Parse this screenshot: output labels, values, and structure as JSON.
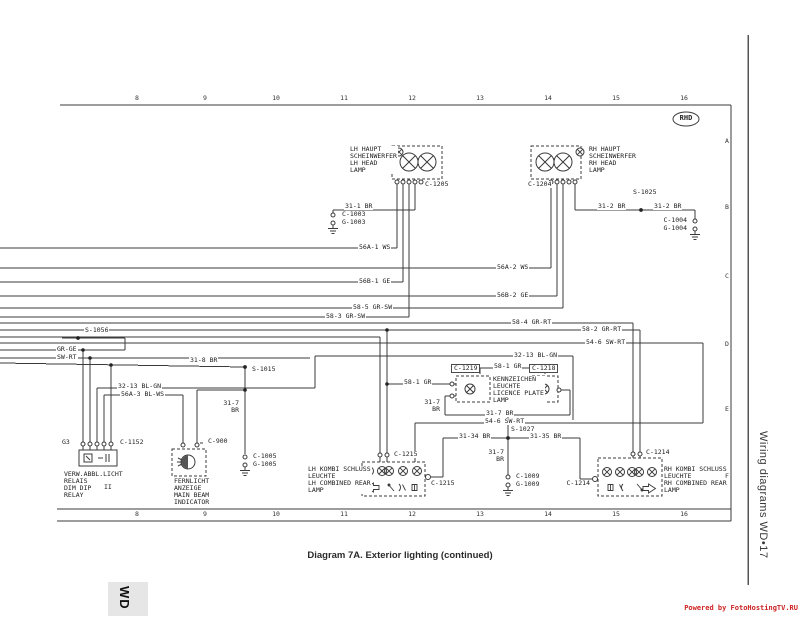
{
  "page": {
    "caption": "Diagram 7A. Exterior lighting (continued)",
    "sidebar_title": "Wiring diagrams  WD•17",
    "corner_tab": "WD",
    "watermark": "Powered by FotoHostingTV.RU",
    "rhd_badge": "RHD",
    "colors": {
      "wire": "#3b3b3b",
      "watermark_red": "#cc2222",
      "paper": "#ffffff"
    }
  },
  "ruler": {
    "top_numbers": [
      "8",
      "9",
      "10",
      "11",
      "12",
      "13",
      "14",
      "15",
      "16"
    ],
    "bottom_numbers": [
      "8",
      "9",
      "10",
      "11",
      "12",
      "13",
      "14",
      "15",
      "16"
    ],
    "number_xs": [
      137,
      205,
      276,
      344,
      412,
      480,
      548,
      616,
      684
    ],
    "row_letters": [
      "A",
      "B",
      "C",
      "D",
      "E",
      "F"
    ],
    "letter_ys": [
      138,
      204,
      273,
      341,
      406,
      473
    ],
    "letter_x": 724
  },
  "components": {
    "lh_headlamp": {
      "connector": "C-1205",
      "grounds": [
        "C-1003",
        "G-1003"
      ]
    },
    "rh_headlamp": {
      "connector": "C-1204",
      "grounds": [
        "C-1004",
        "G-1004"
      ],
      "splice": "S-1025"
    },
    "dim_dip_relay": {
      "connector": "C-1152",
      "pin_group": "G3"
    },
    "main_beam_indicator": {
      "connector": "C-900",
      "grounds": [
        "C-1005",
        "G-1005"
      ]
    },
    "licence_plate_lamp": {
      "connector_left": "C-1219",
      "connector_right": "C-1218"
    },
    "lh_rear_lamp": {
      "connector_top": "C-1215",
      "connector_side": "C-1215"
    },
    "rh_rear_lamp": {
      "connector_top": "C-1214",
      "connector_side": "C-1214",
      "splice": "S-1027",
      "grounds": [
        "C-1009",
        "G-1009"
      ]
    },
    "splices": [
      "S-1025",
      "S-1056",
      "S-1015",
      "S-1027"
    ]
  },
  "labels": [
    {
      "n": "lh-headlamp-label",
      "t": "LH HAUPT\nSCHEINWERFER\nLH HEAD\nLAMP",
      "x": 349,
      "y": 146
    },
    {
      "n": "connector-c1205",
      "t": "C-1205",
      "x": 424,
      "y": 181
    },
    {
      "n": "rh-headlamp-label",
      "t": "RH HAUPT\nSCHEINWERFER\nRH HEAD\nLAMP",
      "x": 588,
      "y": 146
    },
    {
      "n": "connector-c1204",
      "t": "C-1204",
      "x": 527,
      "y": 181
    },
    {
      "n": "wire-31-1-br",
      "t": "31-1 BR",
      "x": 344,
      "y": 203
    },
    {
      "n": "connector-c1003",
      "t": "C-1003",
      "x": 341,
      "y": 211
    },
    {
      "n": "ground-g1003",
      "t": "G-1003",
      "x": 341,
      "y": 219
    },
    {
      "n": "splice-s1025",
      "t": "S-1025",
      "x": 632,
      "y": 189
    },
    {
      "n": "wire-31-2-br-a",
      "t": "31-2 BR",
      "x": 597,
      "y": 203
    },
    {
      "n": "wire-31-2-br-b",
      "t": "31-2 BR",
      "x": 653,
      "y": 203
    },
    {
      "n": "connector-c1004",
      "t": "C-1004",
      "x": 688,
      "y": 217,
      "a": "r"
    },
    {
      "n": "ground-g1004",
      "t": "G-1004",
      "x": 688,
      "y": 225,
      "a": "r"
    },
    {
      "n": "wire-56a-1-ws",
      "t": "56A-1 WS",
      "x": 358,
      "y": 244
    },
    {
      "n": "wire-56a-2-ws",
      "t": "56A-2 WS",
      "x": 496,
      "y": 264
    },
    {
      "n": "wire-56b-1-ge",
      "t": "56B-1 GE",
      "x": 358,
      "y": 278
    },
    {
      "n": "wire-56b-2-ge",
      "t": "56B-2 GE",
      "x": 496,
      "y": 292
    },
    {
      "n": "wire-58-5-gr-sw",
      "t": "58-5 GR-SW",
      "x": 352,
      "y": 304
    },
    {
      "n": "wire-58-3-gr-sw",
      "t": "58-3 GR-SW",
      "x": 325,
      "y": 313
    },
    {
      "n": "wire-58-4-gr-rt",
      "t": "58-4 GR-RT",
      "x": 511,
      "y": 319
    },
    {
      "n": "wire-58-2-gr-rt",
      "t": "58-2 GR-RT",
      "x": 581,
      "y": 326
    },
    {
      "n": "wire-54-6-sw-rt-a",
      "t": "54-6 SW-RT",
      "x": 585,
      "y": 339
    },
    {
      "n": "wire-32-13-bl-gn-a",
      "t": "32-13 BL-GN",
      "x": 513,
      "y": 352
    },
    {
      "n": "splice-s1056",
      "t": "S-1056",
      "x": 84,
      "y": 327
    },
    {
      "n": "wire-gr-ge",
      "t": "GR-GE",
      "x": 56,
      "y": 346
    },
    {
      "n": "wire-sw-rt",
      "t": "SW-RT",
      "x": 56,
      "y": 354
    },
    {
      "n": "wire-31-8-br",
      "t": "31-8 BR",
      "x": 189,
      "y": 357
    },
    {
      "n": "splice-s1015",
      "t": "S-1015",
      "x": 251,
      "y": 366
    },
    {
      "n": "wire-32-13-bl-gn-b",
      "t": "32-13 BL-GN",
      "x": 117,
      "y": 383
    },
    {
      "n": "wire-56a-3-bl-ws",
      "t": "56A-3 BL-WS",
      "x": 120,
      "y": 391
    },
    {
      "n": "wire-31-7-br-a",
      "t": "31-7\nBR",
      "x": 240,
      "y": 400,
      "a": "r"
    },
    {
      "n": "connector-c1005",
      "t": "C-1005",
      "x": 252,
      "y": 453
    },
    {
      "n": "ground-g1005",
      "t": "G-1005",
      "x": 252,
      "y": 461
    },
    {
      "n": "pin-group-g3",
      "t": "G3",
      "x": 61,
      "y": 439
    },
    {
      "n": "connector-c1152",
      "t": "C-1152",
      "x": 119,
      "y": 439
    },
    {
      "n": "relay-label",
      "t": "VERW.ABBL.LICHT\nRELAIS\nDIM DIP\nRELAY",
      "x": 63,
      "y": 471
    },
    {
      "n": "relay-symbol",
      "t": "II",
      "x": 103,
      "y": 484
    },
    {
      "n": "connector-c900",
      "t": "C-900",
      "x": 207,
      "y": 438
    },
    {
      "n": "main-beam-indicator-label",
      "t": "FERNLICHT\nANZEIGE\nMAIN BEAM\nINDICATOR",
      "x": 173,
      "y": 478
    },
    {
      "n": "wire-58-1-gr-a",
      "t": "58-1 GR",
      "x": 403,
      "y": 379
    },
    {
      "n": "connector-c1219",
      "t": "C-1219",
      "x": 451,
      "y": 364,
      "cls": "boxed"
    },
    {
      "n": "wire-58-1-gr-b",
      "t": "58-1 GR",
      "x": 493,
      "y": 363
    },
    {
      "n": "connector-c1218",
      "t": "C-1218",
      "x": 529,
      "y": 364,
      "cls": "boxed"
    },
    {
      "n": "licence-plate-lamp-label",
      "t": "KENNZEICHEN\nLEUCHTE\nLICENCE PLATE\nLAMP",
      "x": 492,
      "y": 376
    },
    {
      "n": "wire-31-7-br-b",
      "t": "31-7\nBR",
      "x": 441,
      "y": 399,
      "a": "r"
    },
    {
      "n": "wire-31-7-br-c",
      "t": "31-7 BR",
      "x": 485,
      "y": 410
    },
    {
      "n": "wire-54-6-sw-rt-b",
      "t": "54-6 SW-RT",
      "x": 484,
      "y": 418
    },
    {
      "n": "splice-s1027",
      "t": "S-1027",
      "x": 510,
      "y": 426
    },
    {
      "n": "wire-31-34-br",
      "t": "31-34 BR",
      "x": 458,
      "y": 433
    },
    {
      "n": "wire-31-35-br",
      "t": "31-35 BR",
      "x": 529,
      "y": 433
    },
    {
      "n": "wire-31-7-br-d",
      "t": "31-7\nBR",
      "x": 505,
      "y": 449,
      "a": "r"
    },
    {
      "n": "connector-c1009",
      "t": "C-1009",
      "x": 515,
      "y": 473
    },
    {
      "n": "ground-g1009",
      "t": "G-1009",
      "x": 515,
      "y": 481
    },
    {
      "n": "connector-c1215-top",
      "t": "C-1215",
      "x": 393,
      "y": 451
    },
    {
      "n": "lh-rear-lamp-label",
      "t": "LH KOMBI SCHLUSS\nLEUCHTE\nLH COMBINED REAR\nLAMP",
      "x": 307,
      "y": 466
    },
    {
      "n": "connector-c1215-side",
      "t": "C-1215",
      "x": 430,
      "y": 480
    },
    {
      "n": "connector-c1214-top",
      "t": "C-1214",
      "x": 645,
      "y": 449
    },
    {
      "n": "rh-rear-lamp-label",
      "t": "RH KOMBI SCHLUSS\nLEUCHTE\nRH COMBINED REAR\nLAMP",
      "x": 663,
      "y": 466
    },
    {
      "n": "connector-c1214-side",
      "t": "C-1214",
      "x": 591,
      "y": 480,
      "a": "r"
    },
    {
      "n": "rhd-badge-text",
      "t": "RHD",
      "x": 686,
      "y": 115,
      "a": "c",
      "cls": "badge"
    }
  ]
}
